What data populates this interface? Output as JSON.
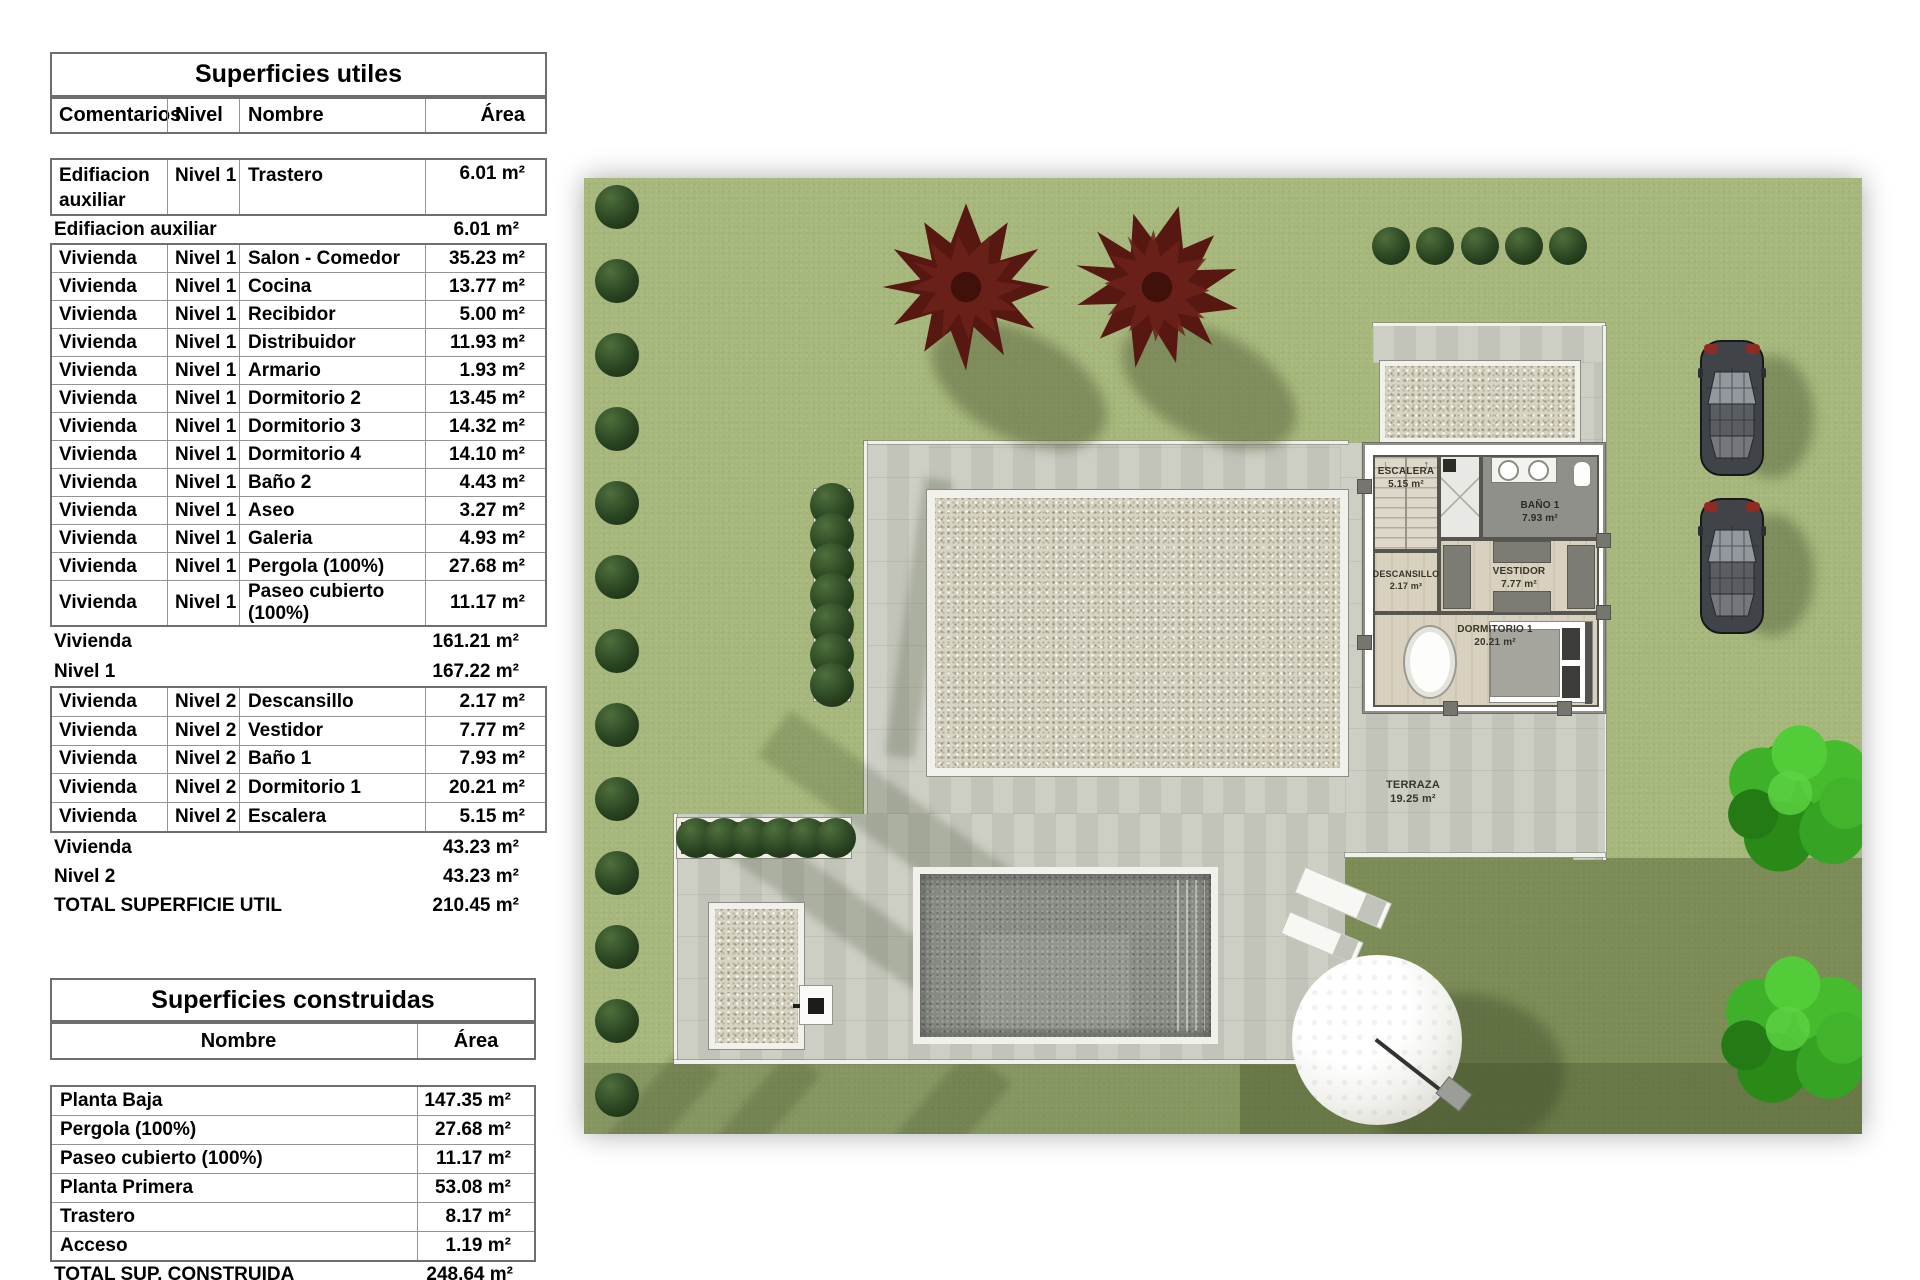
{
  "utiles": {
    "title": "Superficies utiles",
    "col_comentarios": "Comentarios",
    "col_nivel": "Nivel",
    "col_nombre": "Nombre",
    "col_area": "Área",
    "r1": {
      "c": "Edifiacion auxiliar",
      "l": "Nivel 1",
      "n": "Trastero",
      "a": "6.01 m²"
    },
    "s1": {
      "label": "Edifiacion auxiliar",
      "a": "6.01 m²"
    },
    "rows": [
      {
        "c": "Vivienda",
        "l": "Nivel 1",
        "n": "Salon - Comedor",
        "a": "35.23 m²"
      },
      {
        "c": "Vivienda",
        "l": "Nivel 1",
        "n": "Cocina",
        "a": "13.77 m²"
      },
      {
        "c": "Vivienda",
        "l": "Nivel 1",
        "n": "Recibidor",
        "a": "5.00 m²"
      },
      {
        "c": "Vivienda",
        "l": "Nivel 1",
        "n": "Distribuidor",
        "a": "11.93 m²"
      },
      {
        "c": "Vivienda",
        "l": "Nivel 1",
        "n": "Armario",
        "a": "1.93 m²"
      },
      {
        "c": "Vivienda",
        "l": "Nivel 1",
        "n": "Dormitorio 2",
        "a": "13.45 m²"
      },
      {
        "c": "Vivienda",
        "l": "Nivel 1",
        "n": "Dormitorio 3",
        "a": "14.32 m²"
      },
      {
        "c": "Vivienda",
        "l": "Nivel 1",
        "n": "Dormitorio 4",
        "a": "14.10 m²"
      },
      {
        "c": "Vivienda",
        "l": "Nivel 1",
        "n": "Baño 2",
        "a": "4.43 m²"
      },
      {
        "c": "Vivienda",
        "l": "Nivel 1",
        "n": "Aseo",
        "a": "3.27 m²"
      },
      {
        "c": "Vivienda",
        "l": "Nivel 1",
        "n": "Galeria",
        "a": "4.93 m²"
      },
      {
        "c": "Vivienda",
        "l": "Nivel 1",
        "n": "Pergola (100%)",
        "a": "27.68 m²"
      },
      {
        "c": "Vivienda",
        "l": "Nivel 1",
        "n": "Paseo cubierto (100%)",
        "a": "11.17 m²"
      }
    ],
    "s2a": {
      "label": "Vivienda",
      "a": "161.21 m²"
    },
    "s2b": {
      "label": "Nivel 1",
      "a": "167.22 m²"
    },
    "rows2": [
      {
        "c": "Vivienda",
        "l": "Nivel 2",
        "n": "Descansillo",
        "a": "2.17 m²"
      },
      {
        "c": "Vivienda",
        "l": "Nivel 2",
        "n": "Vestidor",
        "a": "7.77 m²"
      },
      {
        "c": "Vivienda",
        "l": "Nivel 2",
        "n": "Baño 1",
        "a": "7.93 m²"
      },
      {
        "c": "Vivienda",
        "l": "Nivel 2",
        "n": "Dormitorio 1",
        "a": "20.21 m²"
      },
      {
        "c": "Vivienda",
        "l": "Nivel 2",
        "n": "Escalera",
        "a": "5.15 m²"
      }
    ],
    "s3a": {
      "label": "Vivienda",
      "a": "43.23 m²"
    },
    "s3b": {
      "label": "Nivel 2",
      "a": "43.23 m²"
    },
    "total": {
      "label": "TOTAL SUPERFICIE UTIL",
      "a": "210.45 m²"
    }
  },
  "construidas": {
    "title": "Superficies construidas",
    "col_nombre": "Nombre",
    "col_area": "Área",
    "rows": [
      {
        "n": "Planta Baja",
        "a": "147.35 m²"
      },
      {
        "n": "Pergola (100%)",
        "a": "27.68 m²"
      },
      {
        "n": "Paseo cubierto (100%)",
        "a": "11.17 m²"
      },
      {
        "n": "Planta Primera",
        "a": "53.08 m²"
      },
      {
        "n": "Trastero",
        "a": "8.17 m²"
      },
      {
        "n": "Acceso",
        "a": "1.19 m²"
      }
    ],
    "total": {
      "label": "TOTAL SUP. CONSTRUIDA",
      "a": "248.64 m²"
    }
  },
  "plan": {
    "rooms": {
      "escalera": {
        "name": "ESCALERA",
        "area": "5.15 m²"
      },
      "bano": {
        "name": "BAÑO 1",
        "area": "7.93 m²"
      },
      "descansillo": {
        "name": "DESCANSILLO",
        "area": "2.17 m²"
      },
      "vestidor": {
        "name": "VESTIDOR",
        "area": "7.77 m²"
      },
      "dormitorio": {
        "name": "DORMITORIO 1",
        "area": "20.21 m²"
      },
      "terraza": {
        "name": "TERRAZA",
        "area": "19.25 m²"
      }
    },
    "icons": {
      "stairs_down": "↓",
      "stairs_up": "↑"
    },
    "colors": {
      "lawn": "#a6b77b",
      "lawn_dark": "#6f8049",
      "paving": "#c9cbc0",
      "gravel": "#d8d4c4",
      "pool_water": "#898c85",
      "planter_soil": "#5d4a35",
      "bush": "#2a4522",
      "tree_dark_red": "#571812",
      "tree_green": "#3aa526",
      "car_body": "#404348",
      "car_taillight": "#8e2b22",
      "dome": "#f4f4f0"
    }
  }
}
